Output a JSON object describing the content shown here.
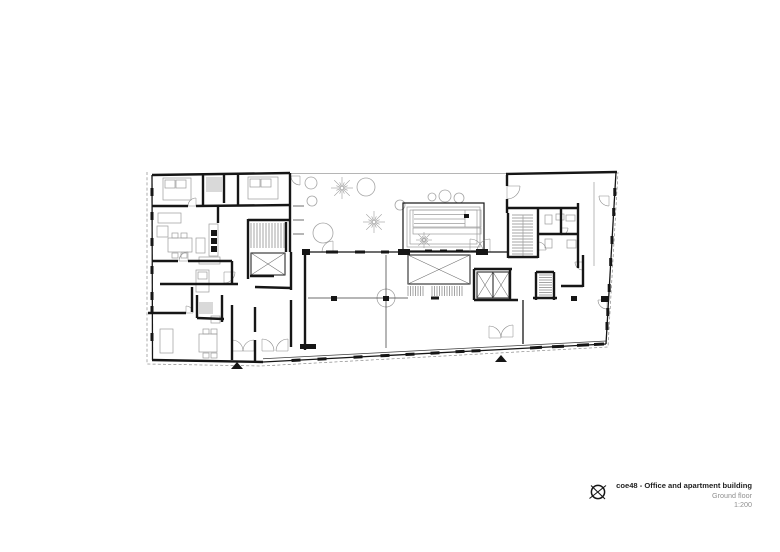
{
  "title_block": {
    "project": "coe48 - Office and apartment building",
    "floor": "Ground floor",
    "scale": "1:200"
  },
  "plan": {
    "colors": {
      "ink": "#161616",
      "mid": "#555555",
      "light": "#9c9c9c",
      "pale": "#d9d9d9",
      "dash": "#8a8a8a",
      "arc": "#8a8a8a",
      "tree": "#a5a5a5"
    },
    "seg": {
      "thick": [
        [
          152,
          175,
          290,
          173
        ],
        [
          506,
          174,
          617,
          172
        ],
        [
          152,
          360,
          263,
          362
        ],
        [
          203,
          175,
          203,
          206
        ],
        [
          152,
          206,
          188,
          206
        ],
        [
          196,
          206,
          291,
          205
        ],
        [
          224,
          175,
          224,
          203
        ],
        [
          238,
          173,
          238,
          206
        ],
        [
          290,
          173,
          290,
          252
        ],
        [
          218,
          205,
          218,
          223
        ],
        [
          152,
          261,
          178,
          261
        ],
        [
          188,
          261,
          232,
          261
        ],
        [
          232,
          261,
          232,
          284
        ],
        [
          160,
          284,
          238,
          284
        ],
        [
          192,
          287,
          192,
          312
        ],
        [
          148,
          313,
          186,
          313
        ],
        [
          197,
          295,
          197,
          318
        ],
        [
          197,
          318,
          224,
          319
        ],
        [
          222,
          295,
          222,
          322
        ],
        [
          232,
          305,
          232,
          360
        ],
        [
          255,
          307,
          255,
          332
        ],
        [
          255,
          340,
          255,
          361
        ],
        [
          248,
          219,
          248,
          279
        ],
        [
          248,
          220,
          291,
          220
        ],
        [
          286,
          222,
          286,
          252
        ],
        [
          250,
          276,
          274,
          276
        ],
        [
          255,
          287,
          291,
          288
        ],
        [
          291,
          252,
          291,
          290
        ],
        [
          291,
          300,
          291,
          347
        ],
        [
          305,
          252,
          305,
          350
        ],
        [
          507,
          175,
          507,
          186
        ],
        [
          507,
          199,
          507,
          213
        ],
        [
          508,
          213,
          508,
          258
        ],
        [
          508,
          208,
          578,
          208
        ],
        [
          538,
          208,
          538,
          258
        ],
        [
          561,
          208,
          561,
          234
        ],
        [
          538,
          234,
          578,
          234
        ],
        [
          578,
          203,
          578,
          268
        ],
        [
          508,
          257,
          538,
          257
        ],
        [
          474,
          269,
          512,
          269
        ],
        [
          474,
          269,
          474,
          300
        ],
        [
          474,
          300,
          518,
          300
        ],
        [
          510,
          269,
          510,
          300
        ],
        [
          536,
          272,
          536,
          300
        ],
        [
          536,
          272,
          554,
          272
        ],
        [
          554,
          272,
          554,
          300
        ],
        [
          533,
          298,
          557,
          298
        ],
        [
          583,
          255,
          583,
          287
        ],
        [
          561,
          286,
          583,
          286
        ]
      ],
      "med": [
        [
          152,
          175,
          152.5,
          360
        ],
        [
          616,
          172,
          606,
          344
        ],
        [
          263,
          362,
          606,
          344
        ],
        [
          306,
          252,
          404,
          252
        ],
        [
          404,
          252,
          484,
          252
        ],
        [
          484,
          252,
          507,
          252
        ],
        [
          523,
          300,
          523,
          344
        ]
      ],
      "thin": [
        [
          263,
          358.8,
          606,
          341
        ],
        [
          308,
          298,
          408,
          298
        ],
        [
          386,
          255,
          386,
          348
        ],
        [
          293,
          206,
          304,
          206
        ],
        [
          293,
          220,
          304,
          220
        ],
        [
          293,
          234,
          304,
          234
        ]
      ],
      "light": [
        [
          290,
          173.5,
          506,
          173.5
        ],
        [
          523,
          215,
          523,
          257
        ],
        [
          594,
          182,
          594,
          266
        ],
        [
          414,
          214.5,
          465,
          214.5
        ],
        [
          414,
          219,
          465,
          219
        ],
        [
          414,
          223.5,
          465,
          223.5
        ],
        [
          465,
          210,
          465,
          227
        ]
      ],
      "tick": [
        [
          152,
          188,
          152,
          196
        ],
        [
          152,
          212,
          152,
          220
        ],
        [
          152,
          238,
          152,
          246
        ],
        [
          152,
          266,
          152,
          274
        ],
        [
          152,
          292,
          152,
          300
        ],
        [
          152,
          306,
          152,
          312
        ],
        [
          152,
          333,
          152,
          341
        ],
        [
          291.5,
          360.5,
          300.5,
          360
        ],
        [
          317.5,
          359.2,
          326.5,
          358.7
        ],
        [
          353.5,
          357.2,
          362.5,
          356.8
        ],
        [
          380.5,
          355.8,
          389.5,
          355.4
        ],
        [
          405.5,
          354.5,
          414.5,
          354.1
        ],
        [
          430.5,
          353.2,
          439.5,
          352.8
        ],
        [
          455.5,
          351.8,
          464.5,
          351.4
        ],
        [
          471.5,
          351,
          480.5,
          350.6
        ],
        [
          530,
          348,
          542,
          347.3
        ],
        [
          552,
          346.8,
          564,
          346.2
        ],
        [
          577,
          345.4,
          589,
          344.8
        ],
        [
          594,
          344.5,
          604,
          344
        ],
        [
          614.8,
          188,
          614.8,
          196
        ],
        [
          613.7,
          208,
          613.7,
          216
        ],
        [
          612,
          236,
          612,
          244
        ],
        [
          610.7,
          258,
          610.7,
          266
        ],
        [
          609.2,
          284,
          609.2,
          292
        ],
        [
          607.8,
          308,
          607.8,
          316
        ],
        [
          607,
          322,
          607,
          330
        ],
        [
          326,
          252,
          338,
          252
        ],
        [
          355,
          252,
          365,
          252
        ],
        [
          381,
          252,
          389,
          252
        ],
        [
          425,
          251,
          432,
          251
        ],
        [
          440,
          251,
          447,
          251
        ],
        [
          456,
          251,
          463,
          251
        ],
        [
          431,
          298,
          439,
          298
        ]
      ]
    },
    "rect": {
      "dark": [
        [
          398,
          249,
          12,
          6
        ],
        [
          476,
          249,
          12,
          6
        ],
        [
          302,
          249,
          8,
          6
        ],
        [
          300,
          344,
          16,
          5
        ],
        [
          331,
          296,
          6,
          5
        ],
        [
          383,
          296,
          6,
          5
        ],
        [
          571,
          296,
          6,
          5
        ],
        [
          601,
          296,
          8,
          6
        ],
        [
          464,
          214,
          5,
          4
        ],
        [
          211,
          230,
          6,
          6
        ],
        [
          211,
          238,
          6,
          6
        ],
        [
          211,
          246,
          6,
          6
        ]
      ],
      "med": [
        [
          403,
          203,
          81,
          48
        ]
      ],
      "light": [
        [
          407,
          207,
          73,
          40
        ],
        [
          410,
          210,
          67,
          34
        ],
        [
          413,
          210,
          68,
          17
        ],
        [
          413,
          228,
          68,
          6
        ],
        [
          163,
          178,
          28,
          22
        ],
        [
          165,
          180,
          10,
          8
        ],
        [
          176,
          180,
          10,
          8
        ],
        [
          248,
          177,
          30,
          22
        ],
        [
          250,
          179,
          10,
          8
        ],
        [
          261,
          179,
          10,
          8
        ],
        [
          158,
          213,
          23,
          10
        ],
        [
          157,
          226,
          11,
          11
        ],
        [
          168,
          238,
          24,
          14
        ],
        [
          172,
          233,
          6,
          5
        ],
        [
          181,
          233,
          6,
          5
        ],
        [
          172,
          253,
          6,
          5
        ],
        [
          181,
          253,
          6,
          5
        ],
        [
          196,
          238,
          9,
          15
        ],
        [
          209,
          224,
          9,
          32
        ],
        [
          196,
          270,
          13,
          22
        ],
        [
          198,
          272,
          9,
          7
        ],
        [
          199,
          257,
          21,
          7
        ],
        [
          160,
          329,
          13,
          24
        ],
        [
          199,
          334,
          18,
          18
        ],
        [
          203,
          329,
          6,
          5
        ],
        [
          211,
          329,
          6,
          5
        ],
        [
          203,
          353,
          6,
          5
        ],
        [
          211,
          353,
          6,
          5
        ],
        [
          545,
          215,
          7,
          9
        ],
        [
          556,
          214,
          8,
          6
        ],
        [
          566,
          215,
          9,
          6
        ],
        [
          545,
          239,
          7,
          9
        ],
        [
          567,
          240,
          9,
          8
        ],
        [
          211,
          316,
          9,
          7
        ]
      ],
      "gray": [
        [
          206,
          177,
          16,
          15
        ],
        [
          199,
          302,
          14,
          12
        ]
      ]
    },
    "xbox": [
      [
        251,
        253,
        34,
        22
      ],
      [
        408,
        255,
        62,
        29
      ],
      [
        477,
        272,
        16,
        26
      ],
      [
        493,
        272,
        16,
        26
      ]
    ],
    "hatch": [
      [
        251,
        223,
        33,
        25,
        3,
        0
      ],
      [
        408,
        286,
        17,
        10,
        2.5,
        0
      ],
      [
        432,
        286,
        30,
        10,
        2.5,
        0
      ],
      [
        512,
        215,
        21,
        42,
        3,
        1
      ],
      [
        539,
        275,
        13,
        21,
        2.5,
        1
      ]
    ],
    "trees": {
      "circle": [
        [
          311,
          183,
          6
        ],
        [
          366,
          187,
          9
        ],
        [
          312,
          201,
          5
        ],
        [
          400,
          205,
          5
        ],
        [
          323,
          233,
          10
        ],
        [
          432,
          197,
          4
        ],
        [
          445,
          196,
          6
        ],
        [
          459,
          198,
          5
        ]
      ],
      "fern": [
        [
          342,
          188,
          11
        ],
        [
          374,
          222,
          11
        ],
        [
          424,
          240,
          8
        ]
      ]
    },
    "arcs": [
      [
        196,
        206,
        8,
        180,
        270
      ],
      [
        188,
        261,
        9,
        180,
        270
      ],
      [
        262,
        351,
        12,
        270,
        360
      ],
      [
        288,
        351,
        12,
        180,
        270
      ],
      [
        232,
        351,
        11,
        270,
        360
      ],
      [
        254,
        351,
        11,
        180,
        270
      ],
      [
        489,
        338,
        12,
        270,
        360
      ],
      [
        513,
        337,
        12,
        180,
        270
      ],
      [
        333,
        252,
        11,
        180,
        270
      ],
      [
        470,
        252,
        13,
        270,
        360
      ],
      [
        490,
        252,
        13,
        180,
        270
      ],
      [
        507,
        186,
        13,
        0,
        90
      ],
      [
        609,
        196,
        10,
        90,
        180
      ],
      [
        607,
        300,
        9,
        90,
        180
      ],
      [
        538,
        250,
        8,
        270,
        360
      ],
      [
        561,
        228,
        7,
        0,
        90
      ],
      [
        583,
        262,
        8,
        90,
        180
      ],
      [
        224,
        272,
        11,
        0,
        90
      ],
      [
        186,
        313,
        7,
        270,
        360
      ],
      [
        300,
        176,
        9,
        90,
        180
      ]
    ],
    "tris": [
      [
        237,
        366
      ],
      [
        501,
        359
      ]
    ],
    "dash": [
      [
        [
          147,
          172
        ],
        [
          147,
          364
        ],
        [
          261,
          366
        ],
        [
          608,
          347
        ],
        [
          618,
          172
        ]
      ]
    ]
  }
}
